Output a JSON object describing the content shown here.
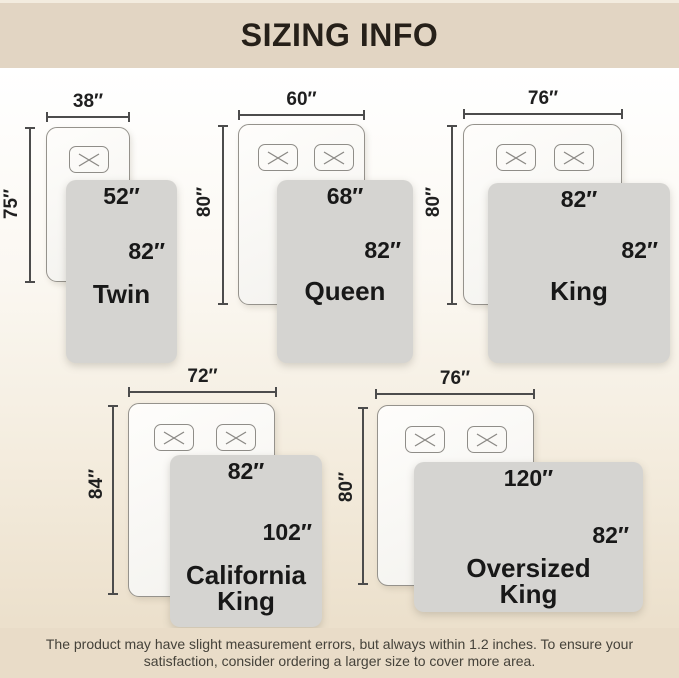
{
  "header": {
    "title": "SIZING INFO"
  },
  "footer": {
    "lines": [
      "The product may have slight measurement errors, but always within 1.2 inches. To ensure your",
      "satisfaction, consider ordering a larger size to cover more area."
    ]
  },
  "colors": {
    "bar_bg": "#e2d5c3",
    "footer_bg": "#e9dcc8",
    "background_top": "#ffffff",
    "background_bottom": "#e9dcc6",
    "blanket": "#d5d4d1",
    "bed": "#f8f7f4",
    "dimension_line": "#4c4c4c",
    "text": "#181818"
  },
  "icons": {
    "pillow_mark": "x-cross"
  },
  "sizes": [
    {
      "name": "Twin",
      "bed_width": "38″",
      "bed_length": "75″",
      "blanket_width": "52″",
      "blanket_length": "82″",
      "pillows": 1
    },
    {
      "name": "Queen",
      "bed_width": "60″",
      "bed_length": "80″",
      "blanket_width": "68″",
      "blanket_length": "82″",
      "pillows": 2
    },
    {
      "name": "King",
      "bed_width": "76″",
      "bed_length": "80″",
      "blanket_width": "82″",
      "blanket_length": "82″",
      "pillows": 2
    },
    {
      "name": "California King",
      "bed_width": "72″",
      "bed_length": "84″",
      "blanket_width": "82″",
      "blanket_length": "102″",
      "pillows": 2
    },
    {
      "name": "Oversized King",
      "bed_width": "76″",
      "bed_length": "80″",
      "blanket_width": "120″",
      "blanket_length": "82″",
      "pillows": 2
    }
  ]
}
